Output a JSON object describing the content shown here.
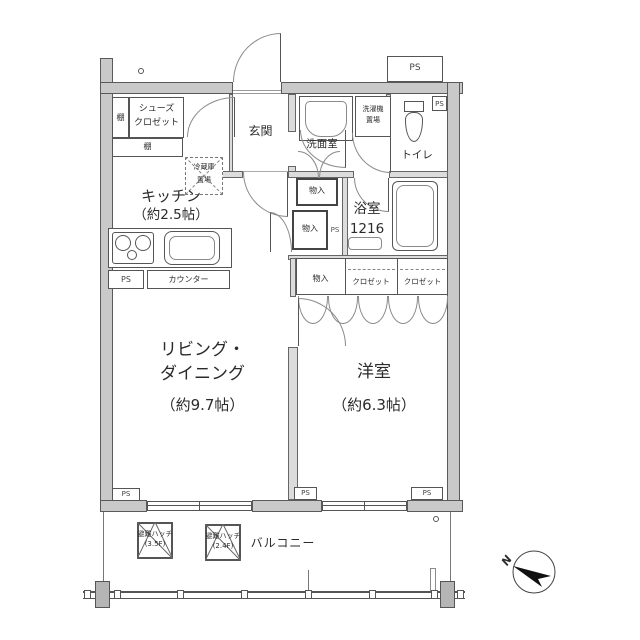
{
  "floorplan": {
    "rooms": {
      "entrance": {
        "label": "玄関"
      },
      "kitchen": {
        "label": "キッチン",
        "size": "（約2.5帖）"
      },
      "living_dining": {
        "label_line1": "リビング・",
        "label_line2": "ダイニング",
        "size": "（約9.7帖）"
      },
      "western_room": {
        "label": "洋室",
        "size": "（約6.3帖）"
      },
      "washroom": {
        "label": "洗面室"
      },
      "toilet": {
        "label": "トイレ"
      },
      "bathroom": {
        "label": "浴室",
        "size_code": "1216"
      },
      "balcony": {
        "label": "バルコニー"
      }
    },
    "features": {
      "shoes_closet_line1": "シューズ",
      "shoes_closet_line2": "クロゼット",
      "shelf": "棚",
      "fridge_space_line1": "冷蔵庫",
      "fridge_space_line2": "置場",
      "washer_space_line1": "洗濯機",
      "washer_space_line2": "置場",
      "counter": "カウンター",
      "storage": "物入",
      "closet": "クロゼット",
      "pipe_space": "PS",
      "hatch_label": "避難ハッチ",
      "hatch1_floors": "(3.5F)",
      "hatch2_floors": "(2.4F)"
    },
    "compass": {
      "north_label": "N"
    },
    "colors": {
      "wall_fill": "#c9c9c9",
      "line": "#555555",
      "arrow": "#111111"
    }
  }
}
